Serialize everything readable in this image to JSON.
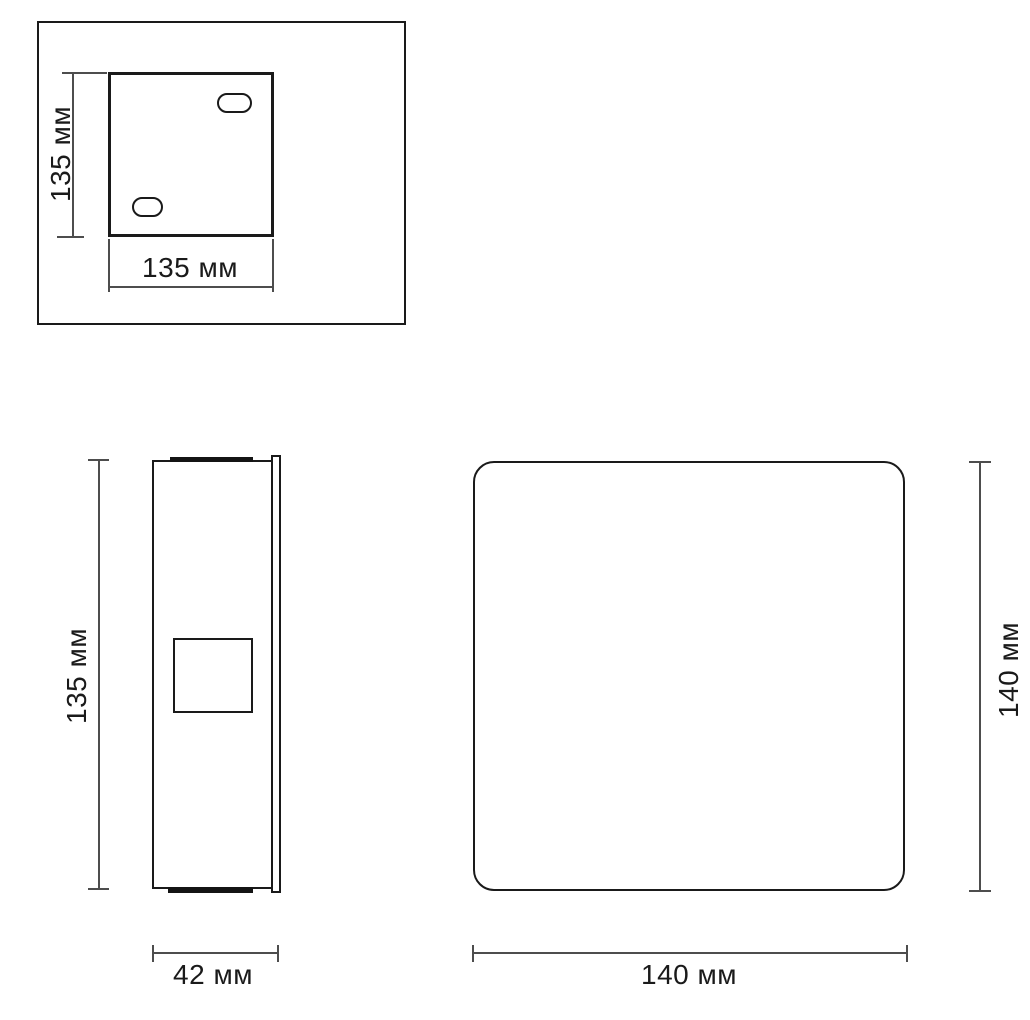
{
  "drawing": {
    "kind": "technical-dimension-drawing",
    "units": "мм",
    "colors": {
      "outline": "#1a1a1a",
      "dimension_line": "#4d4d4d",
      "background": "#ffffff"
    },
    "views": {
      "mounting_plate": {
        "description": "top-left view: mounting plate with two slotted holes inside a frame",
        "height_dim": "135 мм",
        "width_dim": "135 мм"
      },
      "side": {
        "description": "bottom-left view: side profile with cable box",
        "height_dim": "135 мм",
        "depth_dim": "42 мм"
      },
      "front": {
        "description": "bottom-right view: front face, rounded square",
        "height_dim": "140 мм",
        "width_dim": "140 мм"
      }
    }
  }
}
